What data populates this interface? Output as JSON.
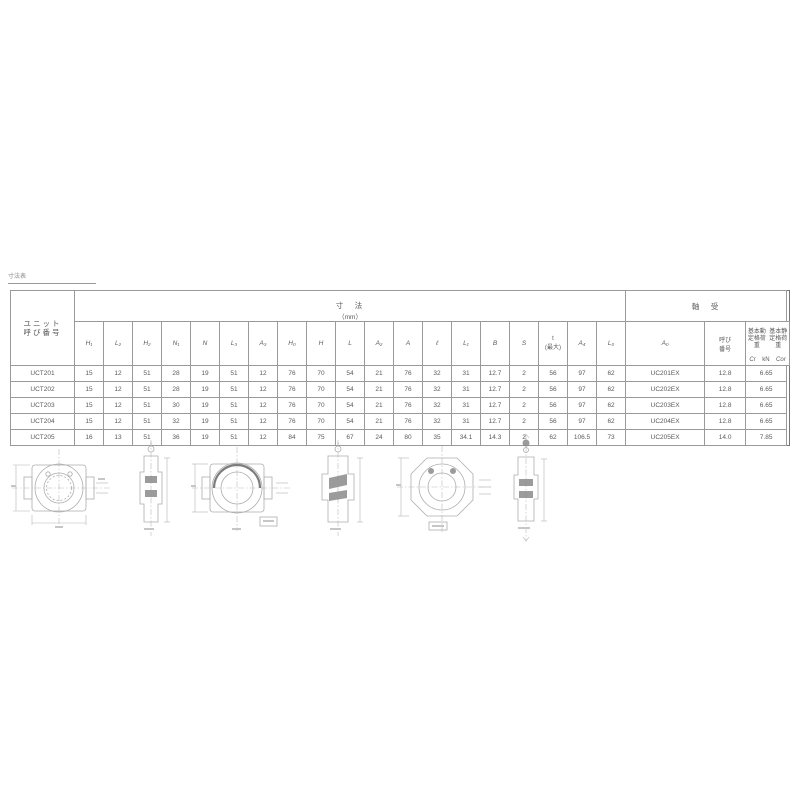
{
  "page": {
    "note": "寸法表"
  },
  "table": {
    "unit_col_header": "ユニット\n呼び番号",
    "dim_header": "寸　法",
    "dim_unit": "（mm）",
    "bearing_header": "軸　受",
    "bearing_no_header": "呼び\n番号",
    "cr_header": "基本動\n定格荷重",
    "cor_header": "基本静\n定格荷重",
    "cr_sym": "Cr",
    "unit_kn": "kN",
    "cor_sym": "Cor",
    "dim_columns": [
      "H₁",
      "L₂",
      "H₂",
      "N₁",
      "N",
      "L₃",
      "A₃",
      "H₀",
      "H",
      "L",
      "A₂",
      "A",
      "ℓ",
      "L₁",
      "B",
      "S",
      "t\n(最大)",
      "A₄",
      "L₀",
      "A₀"
    ],
    "rows": [
      {
        "unit_no": "UCT201",
        "dims": [
          "15",
          "12",
          "51",
          "28",
          "19",
          "51",
          "12",
          "76",
          "70",
          "54",
          "21",
          "76",
          "32",
          "31",
          "12.7",
          "2",
          "56",
          "97",
          "62"
        ],
        "bearing_no": "UC201EX",
        "cr": "12.8",
        "cor": "6.65"
      },
      {
        "unit_no": "UCT202",
        "dims": [
          "15",
          "12",
          "51",
          "28",
          "19",
          "51",
          "12",
          "76",
          "70",
          "54",
          "21",
          "76",
          "32",
          "31",
          "12.7",
          "2",
          "56",
          "97",
          "62"
        ],
        "bearing_no": "UC202EX",
        "cr": "12.8",
        "cor": "6.65"
      },
      {
        "unit_no": "UCT203",
        "dims": [
          "15",
          "12",
          "51",
          "30",
          "19",
          "51",
          "12",
          "76",
          "70",
          "54",
          "21",
          "76",
          "32",
          "31",
          "12.7",
          "2",
          "56",
          "97",
          "62"
        ],
        "bearing_no": "UC203EX",
        "cr": "12.8",
        "cor": "6.65"
      },
      {
        "unit_no": "UCT204",
        "dims": [
          "15",
          "12",
          "51",
          "32",
          "19",
          "51",
          "12",
          "76",
          "70",
          "54",
          "21",
          "76",
          "32",
          "31",
          "12.7",
          "2",
          "56",
          "97",
          "62"
        ],
        "bearing_no": "UC204EX",
        "cr": "12.8",
        "cor": "6.65"
      },
      {
        "unit_no": "UCT205",
        "dims": [
          "16",
          "13",
          "51",
          "36",
          "19",
          "51",
          "12",
          "84",
          "75",
          "67",
          "24",
          "80",
          "35",
          "34.1",
          "14.3",
          "2",
          "62",
          "106.5",
          "73"
        ],
        "bearing_no": "UC205EX",
        "cr": "14.0",
        "cor": "7.85"
      }
    ]
  },
  "colors": {
    "line": "#9a9a9a",
    "text": "#5a5a5a",
    "drawing": "#adadad"
  }
}
